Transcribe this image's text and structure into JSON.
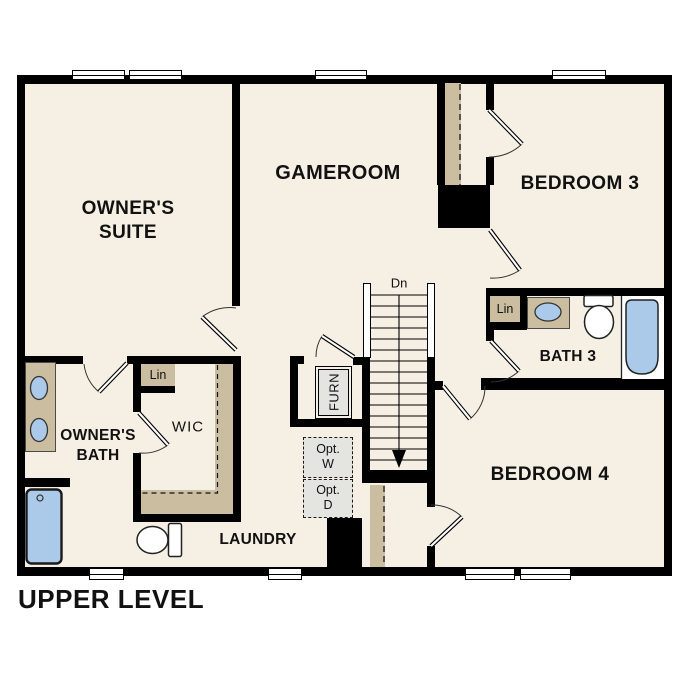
{
  "plan_title": "UPPER LEVEL",
  "rooms": {
    "owners_suite": {
      "line1": "OWNER'S",
      "line2": "SUITE"
    },
    "gameroom": {
      "label": "GAMEROOM"
    },
    "bedroom3": {
      "label": "BEDROOM 3"
    },
    "bath3": {
      "label": "BATH 3"
    },
    "bedroom4": {
      "label": "BEDROOM 4"
    },
    "owners_bath": {
      "line1": "OWNER'S",
      "line2": "BATH"
    },
    "wic": {
      "label": "WIC"
    },
    "laundry": {
      "label": "LAUNDRY"
    }
  },
  "closets": {
    "linen_wic": {
      "label": "Lin"
    },
    "linen_bath3": {
      "label": "Lin"
    },
    "furnace": {
      "label": "FURN"
    }
  },
  "stairs": {
    "down_label": "Dn"
  },
  "optional_appliances": {
    "washer": {
      "line1": "Opt.",
      "line2": "W"
    },
    "dryer": {
      "line1": "Opt.",
      "line2": "D"
    }
  },
  "colors": {
    "background": "#ffffff",
    "floor": "#f6efe3",
    "wall": "#000000",
    "casework_tan": "#cbbda0",
    "fixture_blue": "#abcae9",
    "appliance_gray": "#e4e4e1"
  }
}
